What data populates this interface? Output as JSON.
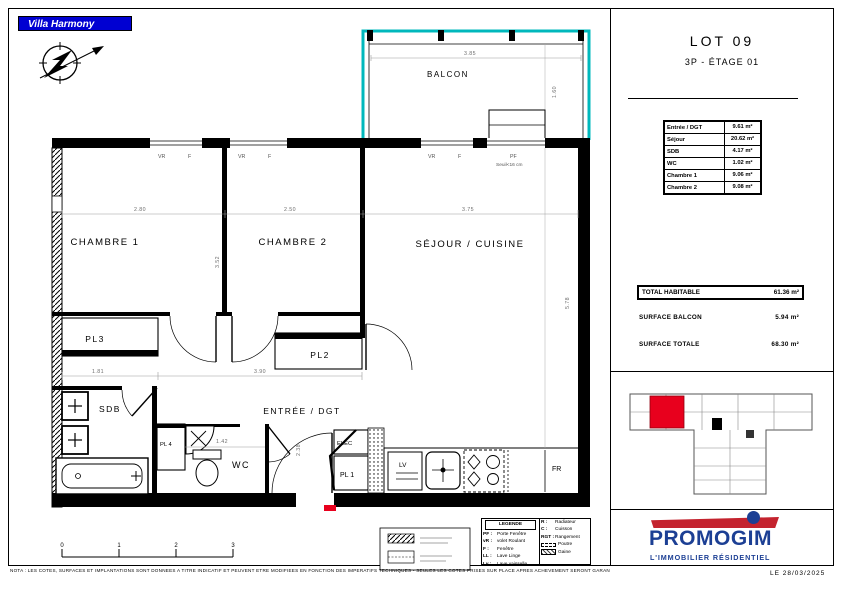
{
  "banner": {
    "title": "Villa Harmony"
  },
  "panel": {
    "lot_title": "LOT 09",
    "lot_subtitle": "3P - ÉTAGE 01",
    "areas": [
      {
        "label": "Entrée / DGT",
        "value": "9.61 m²"
      },
      {
        "label": "Séjour",
        "value": "20.62 m²"
      },
      {
        "label": "SDB",
        "value": "4.17 m²"
      },
      {
        "label": "WC",
        "value": "1.02 m²"
      },
      {
        "label": "Chambre 1",
        "value": "9.06 m²"
      },
      {
        "label": "Chambre 2",
        "value": "9.08 m²"
      }
    ],
    "total_habitable": {
      "label": "TOTAL HABITABLE",
      "value": "61.36 m²"
    },
    "surface_balcon": {
      "label": "SURFACE BALCON",
      "value": "5.94 m²"
    },
    "surface_totale": {
      "label": "SURFACE TOTALE",
      "value": "68.30 m²"
    }
  },
  "plan": {
    "rooms": {
      "balcon": "BALCON",
      "chambre1": "CHAMBRE 1",
      "chambre2": "CHAMBRE 2",
      "sejour": "SÉJOUR / CUISINE",
      "pl3": "PL3",
      "pl2": "PL2",
      "sdb": "SDB",
      "pl4": "PL 4",
      "wc": "WC",
      "entree": "ENTRÉE / DGT",
      "elec": "ELEC",
      "pl1": "PL 1",
      "lv": "LV",
      "fr": "FR"
    },
    "dims": {
      "balcony_width": "3.85",
      "balcony_depth": "1.60",
      "chambre1_width": "2.80",
      "chambre2_width": "2.50",
      "sejour_width": "3.75",
      "chambre_depth": "3.52",
      "sejour_depth": "5.78",
      "sdb_width": "1.81",
      "hall_width": "3.90",
      "wc_width": "1.42",
      "entree_depth": "2.38"
    },
    "openings": {
      "vr": "VR",
      "f": "F",
      "pf": "PF",
      "pf_seuil": "Seuil<16 cm"
    },
    "scale_ticks": [
      "0",
      "1",
      "2",
      "3"
    ]
  },
  "legend": {
    "title": "LEGENDE",
    "left": [
      {
        "abbr": "PF :",
        "label": "Porte Fenêtre"
      },
      {
        "abbr": "vR :",
        "label": "volet Roulant"
      },
      {
        "abbr": "F :",
        "label": "Fenêtre"
      },
      {
        "abbr": "LL :",
        "label": "Lave Linge"
      },
      {
        "abbr": "Lv :",
        "label": "Lave vaisselle"
      }
    ],
    "right": [
      {
        "abbr": "R :",
        "label": "Radiateur"
      },
      {
        "abbr": "C :",
        "label": "Cuisson"
      },
      {
        "abbr": "RGT :",
        "label": "Rangement"
      }
    ],
    "symbols": [
      {
        "type": "dashed",
        "label": "Poutre"
      },
      {
        "type": "hatch",
        "label": "Gaine"
      }
    ]
  },
  "footer": {
    "disclaimer": "NOTA : LES COTES, SURFACES ET IMPLANTATIONS SONT DONNEES A TITRE INDICATIF ET PEUVENT ETRE MODIFIEES EN FONCTION DES IMPERATIFS TECHNIQUES - SEULES LES COTES PRISES SUR PLACE APRES ACHEVEMENT SERONT GARANTIES - DOCUMENT NON CONTRACTUEL",
    "date": "LE  28/03/2025"
  },
  "logo": {
    "name": "PROMOGIM",
    "tagline": "L'IMMOBILIER  RÉSIDENTIEL"
  },
  "colors": {
    "banner_blue": "#0000d2",
    "balcony_cyan": "#00b8bc",
    "logo_blue": "#1c3f94",
    "logo_red": "#c4232e",
    "unit_highlight_red": "#e8001d"
  }
}
